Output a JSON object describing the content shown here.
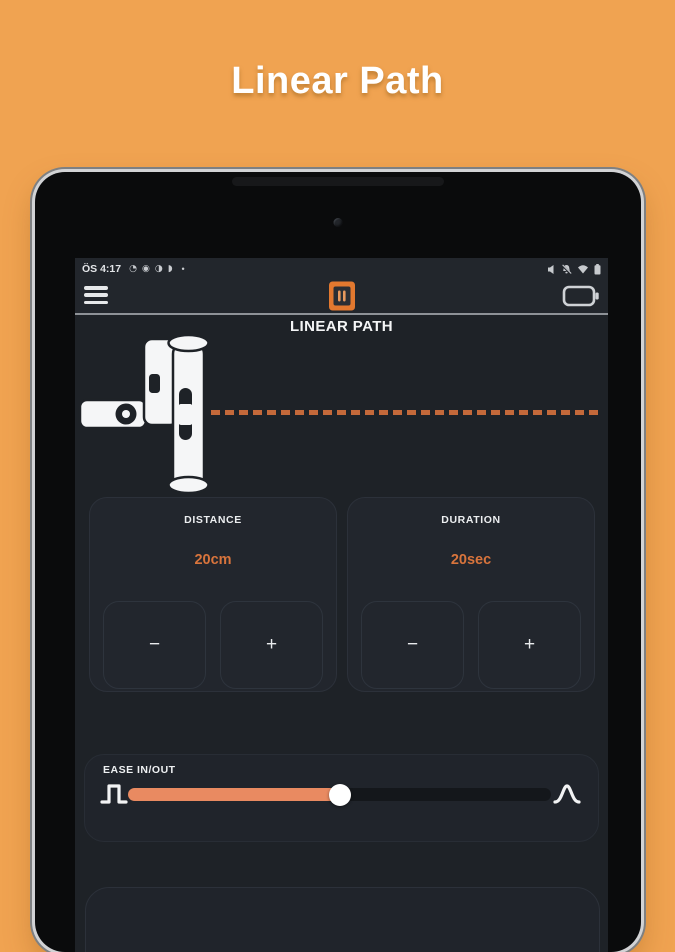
{
  "header": {
    "title": "Linear Path"
  },
  "colors": {
    "page_background": "#f0a351",
    "screen_background": "#1e2227",
    "accent_orange": "#e2782f",
    "value_text": "#d8743c",
    "dashed_path": "#c4693a",
    "slider_fill": "#e98a61"
  },
  "status_bar": {
    "time": "ÖS 4:17",
    "left_icons": [
      "◔",
      "◉",
      "◑",
      "◗"
    ],
    "overflow_dot": "•",
    "right_icon_names": [
      "mute-icon",
      "notifications-off-icon",
      "wifi-icon",
      "battery-icon"
    ]
  },
  "app_bar": {
    "icon_names": [
      "menu-icon",
      "app-logo-icon",
      "device-battery-icon"
    ]
  },
  "screen": {
    "title": "LINEAR PATH",
    "cards": {
      "distance": {
        "label": "DISTANCE",
        "value": "20cm",
        "minus": "−",
        "plus": "+"
      },
      "duration": {
        "label": "DURATION",
        "value": "20sec",
        "minus": "−",
        "plus": "+"
      }
    },
    "ease": {
      "label": "EASE IN/OUT",
      "percent": 50
    }
  }
}
